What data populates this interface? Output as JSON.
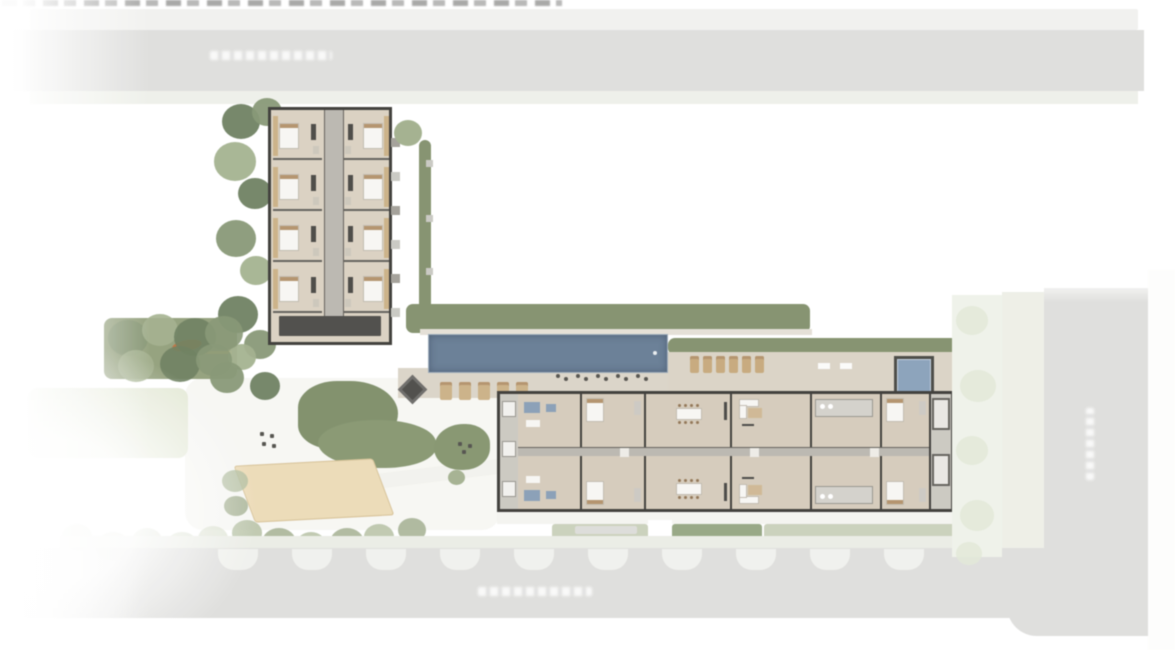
{
  "meta": {
    "description": "Blurred aerial site plan (implantacao) of a residential condominium: an L-shaped arrangement with a vertical apartment tower at the top, a long horizontal apartment block at the lower right, a lap pool with sun deck and spa, sand court, playground, gardens and hedges, bordered by a wide street at top, a street at bottom and a street on the right.",
    "note": "Every text label in the image (cropped caption at top edge, three white street-name labels) is too blurred to be legible."
  },
  "labels": {
    "top_caption": {
      "text": "",
      "legible": false,
      "position": "cropped at very top edge"
    },
    "top_street": {
      "text": "",
      "legible": false,
      "orientation": "horizontal"
    },
    "bottom_street": {
      "text": "",
      "legible": false,
      "orientation": "horizontal"
    },
    "right_street": {
      "text": "",
      "legible": false,
      "orientation": "vertical"
    }
  },
  "palette": {
    "road": "#dcdcda",
    "roadLight": "#f0f0ee",
    "roadBelow": "#edefe8",
    "sidewalk": "#eceee4",
    "paleLawn": "#e3e8d4",
    "lawn": "#8a996f",
    "tree": "#7b8f66",
    "treeDark": "#5f7550",
    "treeLight": "#9aab82",
    "paleTree": "#c9d2b6",
    "hedge": "#79895f",
    "hedgeDark": "#55663f",
    "pool": "#5a7390",
    "spa": "#7f9ab8",
    "deck": "#d8d1c2",
    "sand": "#ebd8ad",
    "sandEdge": "#d6bd8a",
    "wall": "#2e2d29",
    "floorA": "#d8cdbb",
    "floorB": "#d3c7b4",
    "corridor": "#b5b1a9",
    "wood": "#b08a5c",
    "woodLight": "#c9ab79",
    "orange": "#c0662d",
    "blue": "#7d97b3",
    "grayBalcony": "#c7c4bb",
    "benchGray": "#c4c4be",
    "pathLight": "#f4f4f0",
    "white": "#ffffff",
    "darkDot": "#46453f",
    "coreDark": "#3f3e3a"
  },
  "site": {
    "buildings": [
      {
        "id": "north-tower",
        "orientation": "vertical",
        "unit_rows": 4,
        "unit_cols": 2,
        "has_central_corridor": true,
        "has_service_core": true
      },
      {
        "id": "south-block",
        "orientation": "horizontal",
        "unit_rows": 2,
        "has_central_corridor": true,
        "top_unit_types": [
          "lounge",
          "bed",
          "dining",
          "living",
          "bath",
          "bed"
        ],
        "bottom_unit_types": [
          "lounge",
          "bed",
          "dining",
          "living",
          "bath",
          "bed"
        ],
        "balconies": "both-ends"
      }
    ],
    "amenities": [
      "lap-pool",
      "spa",
      "sun-deck",
      "sun-loungers",
      "shade-sail",
      "bistro-tables",
      "sand-court",
      "playground",
      "gardens",
      "hedges",
      "street-parking-bays"
    ],
    "counts": {
      "poolside_loungers": 5,
      "terrace_loungers": 6,
      "bistro_sets": 5,
      "parking_bays": 10,
      "spa_pools": 1,
      "lap_pools": 1,
      "sand_courts": 1
    }
  }
}
